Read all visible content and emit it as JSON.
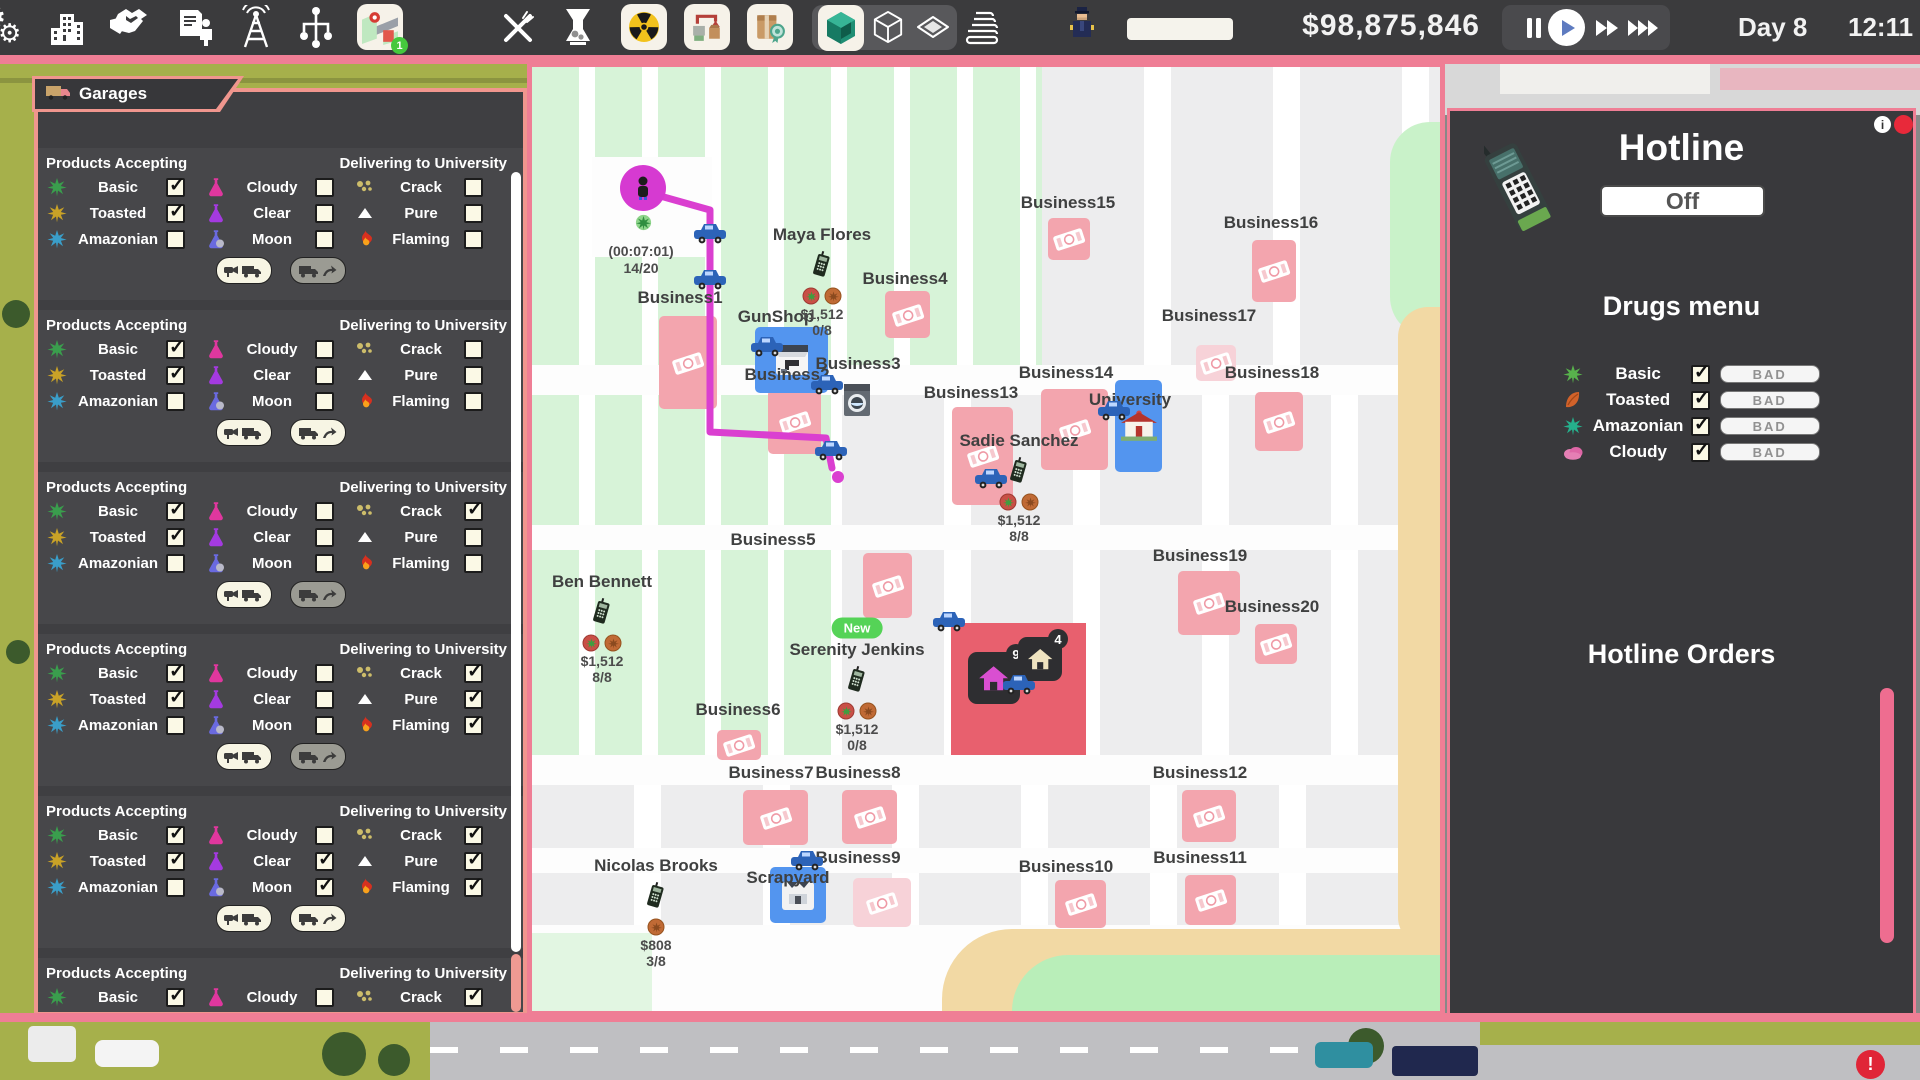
{
  "topbar": {
    "money": "$98,875,846",
    "day_label": "Day 8",
    "time_label": "12:11",
    "map_badge": "1",
    "icons": [
      "gears",
      "city",
      "handshake",
      "contract",
      "antenna",
      "network",
      "map",
      "cutlery",
      "grinder",
      "radiation",
      "processing",
      "product",
      "cube-green",
      "cube-white",
      "diamond",
      "books",
      "police"
    ],
    "speed_controls": [
      "pause",
      "play",
      "fast",
      "fastest"
    ]
  },
  "colors": {
    "accent_pink": "#ef7e95",
    "salmon": "#f0968e",
    "map_blue": "#5395ef",
    "map_red": "#e8606e",
    "magenta": "#da3fd0",
    "tile_pink": "#f3a5ae"
  },
  "garages": {
    "title": "Garages",
    "products_header": "Products Accepting",
    "delivering_header": "Delivering to University",
    "products": [
      {
        "icon": "leaf-green",
        "label": "Basic"
      },
      {
        "icon": "leaf-yellow",
        "label": "Toasted"
      },
      {
        "icon": "leaf-blue",
        "label": "Amazonian"
      },
      {
        "icon": "flask-pink",
        "label": "Cloudy"
      },
      {
        "icon": "flask-purple",
        "label": "Clear"
      },
      {
        "icon": "flask-moon",
        "label": "Moon"
      },
      {
        "icon": "crumbs",
        "label": "Crack"
      },
      {
        "icon": "triangle",
        "label": "Pure"
      },
      {
        "icon": "flame",
        "label": "Flaming"
      }
    ],
    "sections": [
      {
        "checks": [
          1,
          1,
          0,
          0,
          0,
          0,
          0,
          0,
          0
        ],
        "send_btn": "gray"
      },
      {
        "checks": [
          1,
          1,
          0,
          0,
          0,
          0,
          0,
          0,
          0
        ],
        "send_btn": "cream"
      },
      {
        "checks": [
          1,
          1,
          0,
          0,
          0,
          0,
          1,
          0,
          0
        ],
        "send_btn": "gray"
      },
      {
        "checks": [
          1,
          1,
          0,
          0,
          0,
          0,
          1,
          1,
          1
        ],
        "send_btn": "gray"
      },
      {
        "checks": [
          1,
          1,
          0,
          0,
          1,
          1,
          1,
          1,
          1
        ],
        "send_btn": "cream"
      },
      {
        "checks": [
          1,
          1,
          0,
          0,
          0,
          0,
          1,
          1,
          0
        ],
        "send_btn": "cream"
      }
    ]
  },
  "map": {
    "player": {
      "x": 111,
      "y": 121,
      "timer": "(00:07:01)",
      "capacity": "14/20"
    },
    "route_points": "114,125 178,143 178,365 294,371 300,401",
    "businesses": [
      {
        "name": "Business1",
        "lx": 148,
        "ly": 231,
        "tile": [
          127,
          249,
          58,
          93
        ]
      },
      {
        "name": "Business2",
        "lx": 255,
        "ly": 308,
        "tile": [
          236,
          322,
          53,
          65
        ]
      },
      {
        "name": "Business3",
        "lx": 326,
        "ly": 297
      },
      {
        "name": "Business4",
        "lx": 373,
        "ly": 212,
        "tile": [
          353,
          224,
          45,
          47
        ]
      },
      {
        "name": "Business5",
        "lx": 241,
        "ly": 473,
        "tile": [
          331,
          486,
          49,
          65
        ]
      },
      {
        "name": "Business6",
        "lx": 206,
        "ly": 643,
        "tile": [
          185,
          663,
          44,
          30
        ]
      },
      {
        "name": "Business7",
        "lx": 239,
        "ly": 706,
        "tile": [
          211,
          723,
          65,
          55
        ]
      },
      {
        "name": "Business8",
        "lx": 326,
        "ly": 706,
        "tile": [
          310,
          723,
          55,
          54
        ]
      },
      {
        "name": "Business9",
        "lx": 326,
        "ly": 791,
        "tile": [
          321,
          811,
          58,
          49
        ],
        "faded": true
      },
      {
        "name": "Business10",
        "lx": 534,
        "ly": 800,
        "tile": [
          523,
          813,
          51,
          48
        ]
      },
      {
        "name": "Business11",
        "lx": 668,
        "ly": 791,
        "tile": [
          653,
          808,
          51,
          50
        ]
      },
      {
        "name": "Business12",
        "lx": 668,
        "ly": 706,
        "tile": [
          650,
          723,
          54,
          52
        ]
      },
      {
        "name": "Business13",
        "lx": 439,
        "ly": 326,
        "tile": [
          420,
          340,
          61,
          98
        ]
      },
      {
        "name": "Business14",
        "lx": 534,
        "ly": 306,
        "tile": [
          509,
          322,
          67,
          81
        ]
      },
      {
        "name": "Business15",
        "lx": 536,
        "ly": 136,
        "tile": [
          516,
          151,
          42,
          42
        ]
      },
      {
        "name": "Business16",
        "lx": 739,
        "ly": 156,
        "tile": [
          720,
          173,
          44,
          62
        ]
      },
      {
        "name": "Business17",
        "lx": 677,
        "ly": 249,
        "tile": [
          664,
          278,
          40,
          36
        ],
        "faded": true
      },
      {
        "name": "Business18",
        "lx": 740,
        "ly": 306,
        "tile": [
          723,
          325,
          48,
          59
        ]
      },
      {
        "name": "Business19",
        "lx": 668,
        "ly": 489,
        "tile": [
          646,
          504,
          62,
          64
        ]
      },
      {
        "name": "Business20",
        "lx": 740,
        "ly": 540,
        "tile": [
          723,
          557,
          42,
          40
        ]
      }
    ],
    "landmarks": [
      {
        "kind": "gunshop",
        "name": "GunShop",
        "lx": 244,
        "ly": 250,
        "tile": [
          223,
          260,
          73,
          66
        ],
        "car": [
          218,
          268
        ]
      },
      {
        "kind": "university",
        "name": "University",
        "lx": 598,
        "ly": 333,
        "tile": [
          583,
          313,
          47,
          92
        ],
        "car": [
          565,
          332
        ]
      },
      {
        "kind": "scrapyard",
        "name": "Scrapyard",
        "lx": 256,
        "ly": 811,
        "tile": [
          238,
          800,
          56,
          56
        ],
        "car": [
          258,
          782
        ]
      }
    ],
    "red_building": {
      "x": 419,
      "y": 556,
      "w": 135,
      "h": 132,
      "houses": [
        {
          "color": "#d94fd1",
          "count": "9",
          "x": 436,
          "y": 585,
          "s": 52
        },
        {
          "color": "#efe3c0",
          "count": "4",
          "x": 486,
          "y": 570,
          "s": 44
        }
      ],
      "truck": [
        470,
        606
      ]
    },
    "washer": [
      310,
      315
    ],
    "cars": [
      [
        161,
        155
      ],
      [
        161,
        201
      ],
      [
        278,
        306
      ],
      [
        282,
        372
      ],
      [
        442,
        400
      ],
      [
        400,
        543
      ]
    ],
    "route_end_dot": [
      300,
      404
    ],
    "dealers": [
      {
        "name": "Maya Flores",
        "x": 290,
        "y": 168,
        "coins": [
          "leaf",
          "toast"
        ],
        "price": "$1,512",
        "ratio": "0/8"
      },
      {
        "name": "Sadie Sanchez",
        "x": 487,
        "y": 374,
        "coins": [
          "leaf",
          "toast"
        ],
        "price": "$1,512",
        "ratio": "8/8"
      },
      {
        "name": "Ben Bennett",
        "x": 70,
        "y": 515,
        "coins": [
          "leaf",
          "toast"
        ],
        "price": "$1,512",
        "ratio": "8/8"
      },
      {
        "name": "Serenity Jenkins",
        "x": 325,
        "y": 583,
        "badge": "New",
        "coins": [
          "leaf",
          "toast"
        ],
        "price": "$1,512",
        "ratio": "0/8"
      },
      {
        "name": "Nicolas Brooks",
        "x": 124,
        "y": 799,
        "coins": [
          "toast"
        ],
        "price": "$808",
        "ratio": "3/8"
      }
    ]
  },
  "hotline": {
    "title": "Hotline",
    "toggle_label": "Off",
    "drugs_title": "Drugs menu",
    "orders_title": "Hotline Orders",
    "bad_label": "BAD",
    "drugs": [
      {
        "icon": "leaf-basic",
        "label": "Basic",
        "checked": true
      },
      {
        "icon": "leaf-toasted",
        "label": "Toasted",
        "checked": true
      },
      {
        "icon": "leaf-amazonian",
        "label": "Amazonian",
        "checked": true
      },
      {
        "icon": "cloud",
        "label": "Cloudy",
        "checked": true
      }
    ]
  }
}
